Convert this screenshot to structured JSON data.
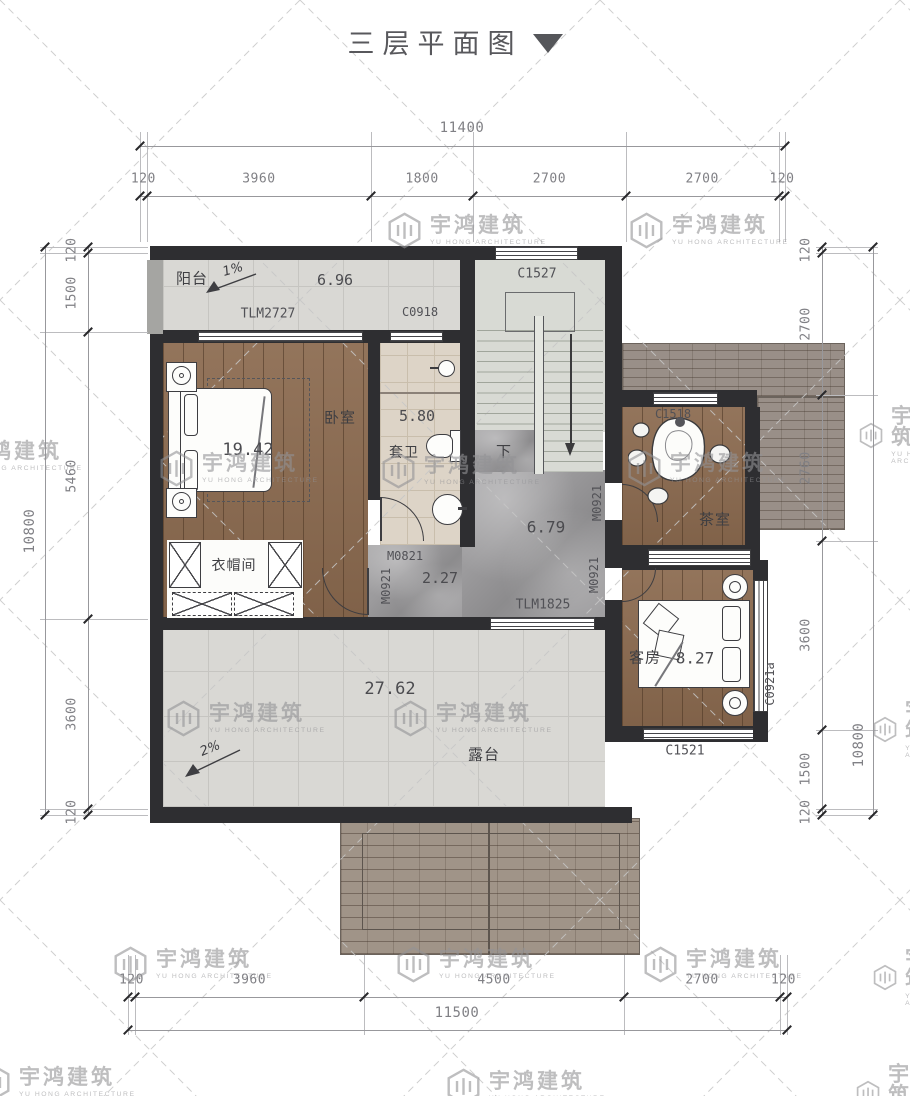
{
  "title": {
    "text": "三层平面图"
  },
  "watermark": {
    "cn": "宇鸿建筑",
    "en": "YU HONG ARCHITECTURE"
  },
  "dimensions": {
    "top": {
      "overall": "11400",
      "segments": [
        "120",
        "3960",
        "1800",
        "2700",
        "2700",
        "120"
      ]
    },
    "bottom": {
      "overall": "11500",
      "segments": [
        "120",
        "3960",
        "4500",
        "2700",
        "120"
      ]
    },
    "left": {
      "overall": "10800",
      "segments": [
        "120",
        "1500",
        "5460",
        "3600",
        "120"
      ]
    },
    "right": {
      "overall": "10800",
      "segments": [
        "120",
        "2700",
        "2760",
        "3600",
        "1500",
        "120"
      ]
    }
  },
  "rooms": {
    "balcony": {
      "name": "阳台",
      "area": "6.96",
      "slope": "1%"
    },
    "bedroom": {
      "name": "卧室",
      "area": "19.42"
    },
    "ensuite": {
      "name": "套卫",
      "area": "5.80"
    },
    "cloakroom": {
      "name": "衣帽间"
    },
    "hall": {
      "area": "6.79"
    },
    "corridor": {
      "area": "2.27"
    },
    "tea_room": {
      "name": "茶室"
    },
    "guest_room": {
      "name": "客房",
      "area": "8.27"
    },
    "terrace": {
      "name": "露台",
      "area": "27.62",
      "slope": "2%"
    },
    "stairs": {
      "down_label": "下"
    }
  },
  "openings": {
    "tlm2727": "TLM2727",
    "c0918": "C0918",
    "c1527": "C1527",
    "c1518": "C1518",
    "m0821": "M0821",
    "m0921": "M0921",
    "tlm1825": "TLM1825",
    "c1521": "C1521",
    "c0921a": "C0921a"
  }
}
